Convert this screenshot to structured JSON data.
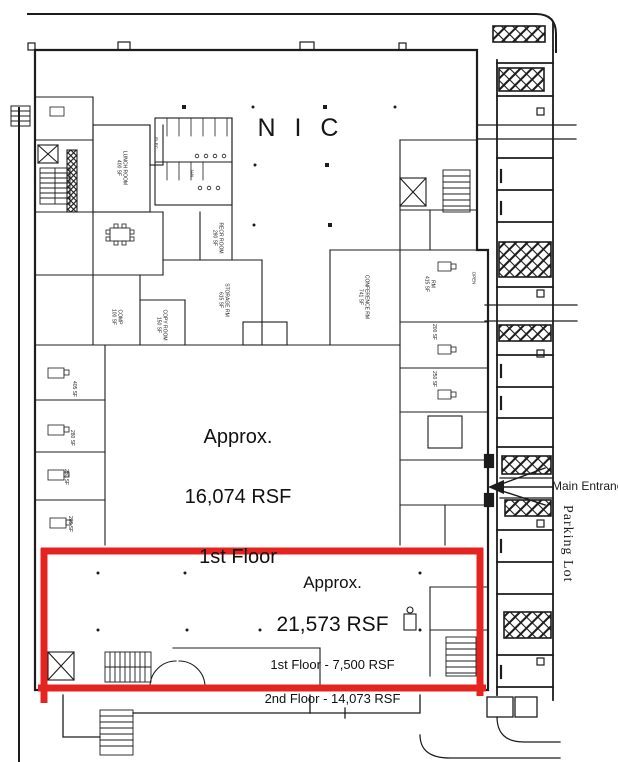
{
  "document": {
    "nic_label": "N I C",
    "main_area": {
      "line1": "Approx.",
      "line2": "16,074 RSF",
      "line3": "1st Floor"
    },
    "highlighted_area": {
      "line1": "Approx.",
      "line2": "21,573 RSF",
      "line3": "1st Floor - 7,500 RSF",
      "line4": "2nd Floor - 14,073 RSF"
    },
    "main_entrance_label": "Main Entrance",
    "parking_lot_label": "Parking Lot"
  },
  "colors": {
    "highlight": "#e52420",
    "ink": "#1c1c1c",
    "paper": "#ffffff"
  },
  "room_labels": [
    {
      "id": "lunch-room",
      "label": "LUNCH ROOM\n400 SF"
    },
    {
      "id": "elec-closet",
      "label": "ELEC"
    },
    {
      "id": "jan-closet",
      "label": "JAN"
    },
    {
      "id": "recr-room",
      "label": "RECR ROOM\n280 SF"
    },
    {
      "id": "storage-room",
      "label": "STORAGE RM\n615 SF"
    },
    {
      "id": "comp-room",
      "label": "COMP\n100 SF"
    },
    {
      "id": "copy-room",
      "label": "COPY ROOM\n150 SF"
    },
    {
      "id": "conference-room",
      "label": "CONFERENCE RM\n741 SF"
    },
    {
      "id": "rm-415",
      "label": "RM\n415 SF"
    },
    {
      "id": "open-tag",
      "label": "OPEN"
    },
    {
      "id": "office-200",
      "label": "200 SF"
    },
    {
      "id": "office-250",
      "label": "250 SF"
    },
    {
      "id": "office-405",
      "label": "405 SF"
    },
    {
      "id": "office-280-a",
      "label": "280 SF"
    },
    {
      "id": "office-280-b",
      "label": "280 SF"
    },
    {
      "id": "office-285",
      "label": "285 SF"
    }
  ]
}
